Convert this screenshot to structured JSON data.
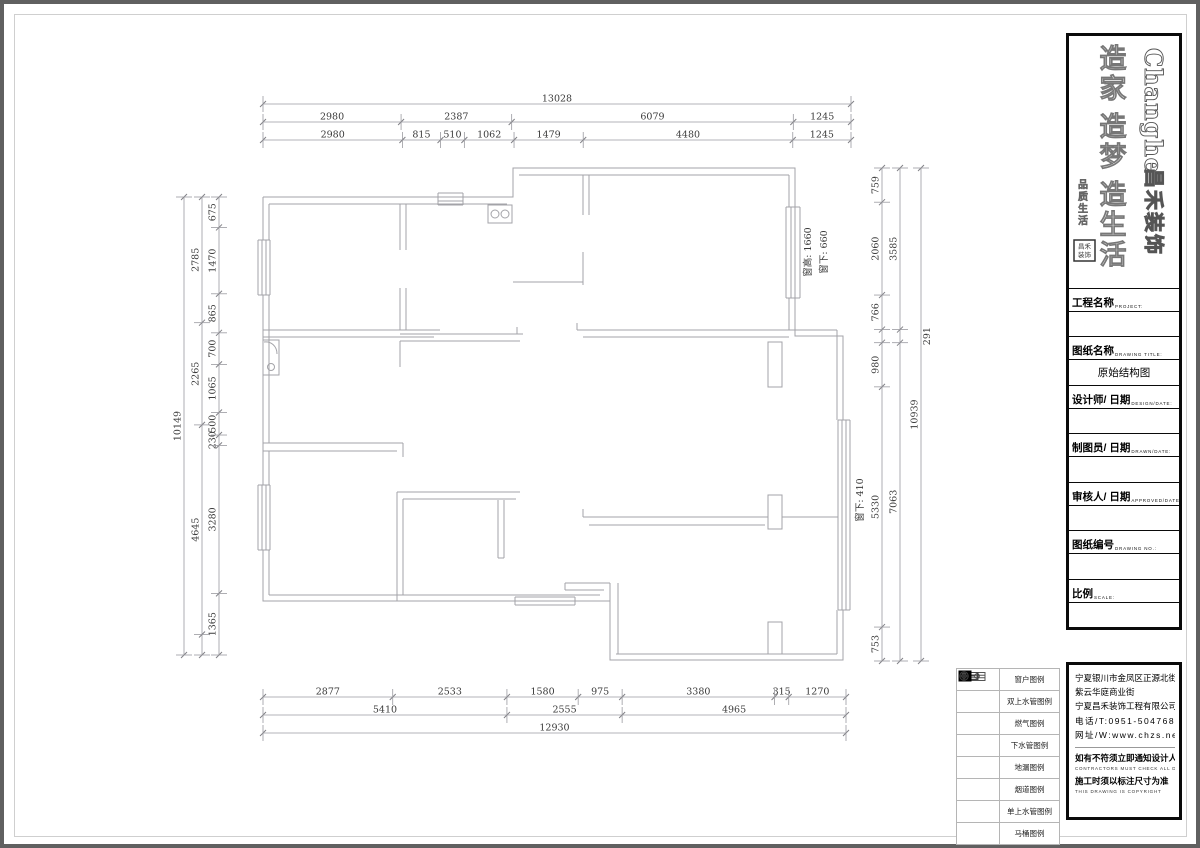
{
  "drawing": {
    "title": "原始结构图"
  },
  "dimensions": {
    "top": {
      "total": "13028",
      "row2": [
        "2980",
        "2387",
        "6079",
        "1245"
      ],
      "row3": [
        "2980",
        "815",
        "510",
        "1062",
        "1479",
        "4480",
        "1245"
      ]
    },
    "bottom": {
      "row1": [
        "2877",
        "2533",
        "1580",
        "975",
        "3380",
        "315",
        "1270"
      ],
      "row2": [
        "5410",
        "2555",
        "4965"
      ],
      "total": "12930"
    },
    "left": {
      "total": "10149",
      "mid": [
        "2785",
        "2265",
        "4645"
      ],
      "inner": [
        "675",
        "1470",
        "865",
        "700",
        "1065",
        "500",
        "230",
        "3280",
        "1365"
      ]
    },
    "right": {
      "inner": [
        "759",
        "2060",
        "766",
        "980",
        "5330",
        "753"
      ],
      "mid": [
        "3585",
        "291",
        "7063"
      ],
      "total": "10939"
    }
  },
  "annotations": {
    "window_height": "窗高: 1660",
    "window_sill": "窗下: 660",
    "window_sill2": "窗下: 410"
  },
  "title_block": {
    "logo_en": "Changhe",
    "logo_cn": "昌禾装饰",
    "slogan": "造家 造梦 造生活",
    "slogan_small": "品质生活",
    "fields": [
      {
        "cn": "工程名称",
        "en": "PROJECT:",
        "value": ""
      },
      {
        "cn": "图纸名称",
        "en": "DRAWING TITLE:",
        "value": "原始结构图"
      },
      {
        "cn": "设计师/ 日期",
        "en": "DESIGN/DATE:",
        "value": ""
      },
      {
        "cn": "制图员/ 日期",
        "en": "DRAWN/DATE:",
        "value": ""
      },
      {
        "cn": "审核人/ 日期",
        "en": "APPROVED/DATE:",
        "value": ""
      },
      {
        "cn": "图纸编号",
        "en": "DRAWING NO.:",
        "value": ""
      },
      {
        "cn": "比例",
        "en": "SCALE:",
        "value": ""
      }
    ]
  },
  "info_block": {
    "address1": "宁夏银川市金凤区正源北街",
    "address2": "紫云华庭商业街",
    "company": "宁夏昌禾装饰工程有限公司",
    "phone": "电话/T:0951-5047688",
    "web": "网址/W:www.chzs.net",
    "note1_cn": "如有不符须立即通知设计人员",
    "note1_en": "CONTRACTORS MUST CHECK ALL DIMENSIONS",
    "note2_cn": "施工时须以标注尺寸为准",
    "note2_en": "THIS DRAWING IS COPYRIGHT"
  },
  "legend": {
    "rows": [
      {
        "icon": "window-icon",
        "label": "窗户图例"
      },
      {
        "icon": "double-water-pipe-icon",
        "label": "双上水管图例"
      },
      {
        "icon": "gas-icon",
        "label": "燃气图例"
      },
      {
        "icon": "drain-pipe-icon",
        "label": "下水管图例"
      },
      {
        "icon": "floor-drain-icon",
        "label": "地漏图例"
      },
      {
        "icon": "flue-icon",
        "label": "烟道图例"
      },
      {
        "icon": "single-water-pipe-icon",
        "label": "单上水管图例"
      },
      {
        "icon": "toilet-icon",
        "label": "马桶图例"
      }
    ]
  },
  "colors": {
    "wall": "#a3a3a8",
    "dim_line": "#9a9aa0",
    "dim_text": "#3a3a3a",
    "frame": "#606060"
  }
}
